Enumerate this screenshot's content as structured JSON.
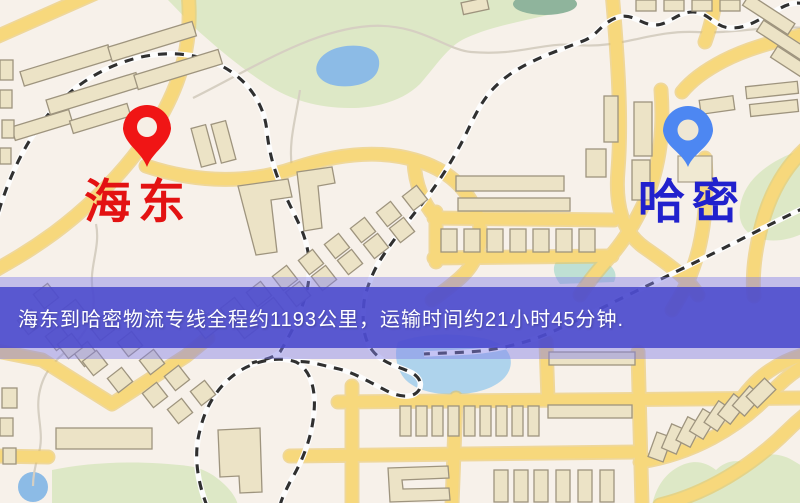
{
  "origin": {
    "label": "海东",
    "pin_color": "#f01515",
    "label_color": "#e31212"
  },
  "destination": {
    "label": "哈密",
    "pin_color": "#4d87f2",
    "label_color": "#2121cd"
  },
  "banner": {
    "text": "海东到哈密物流专线全程约1193公里，运输时间约21小时45分钟.",
    "background": "#4a48cc",
    "text_color": "#ffffff"
  },
  "colors": {
    "map_background": "#f7f1ea",
    "road": "#f7d87c",
    "building": "#ece3c6",
    "park": "#dde8c6",
    "water": "#8cbbe6",
    "railway": "#303030"
  }
}
